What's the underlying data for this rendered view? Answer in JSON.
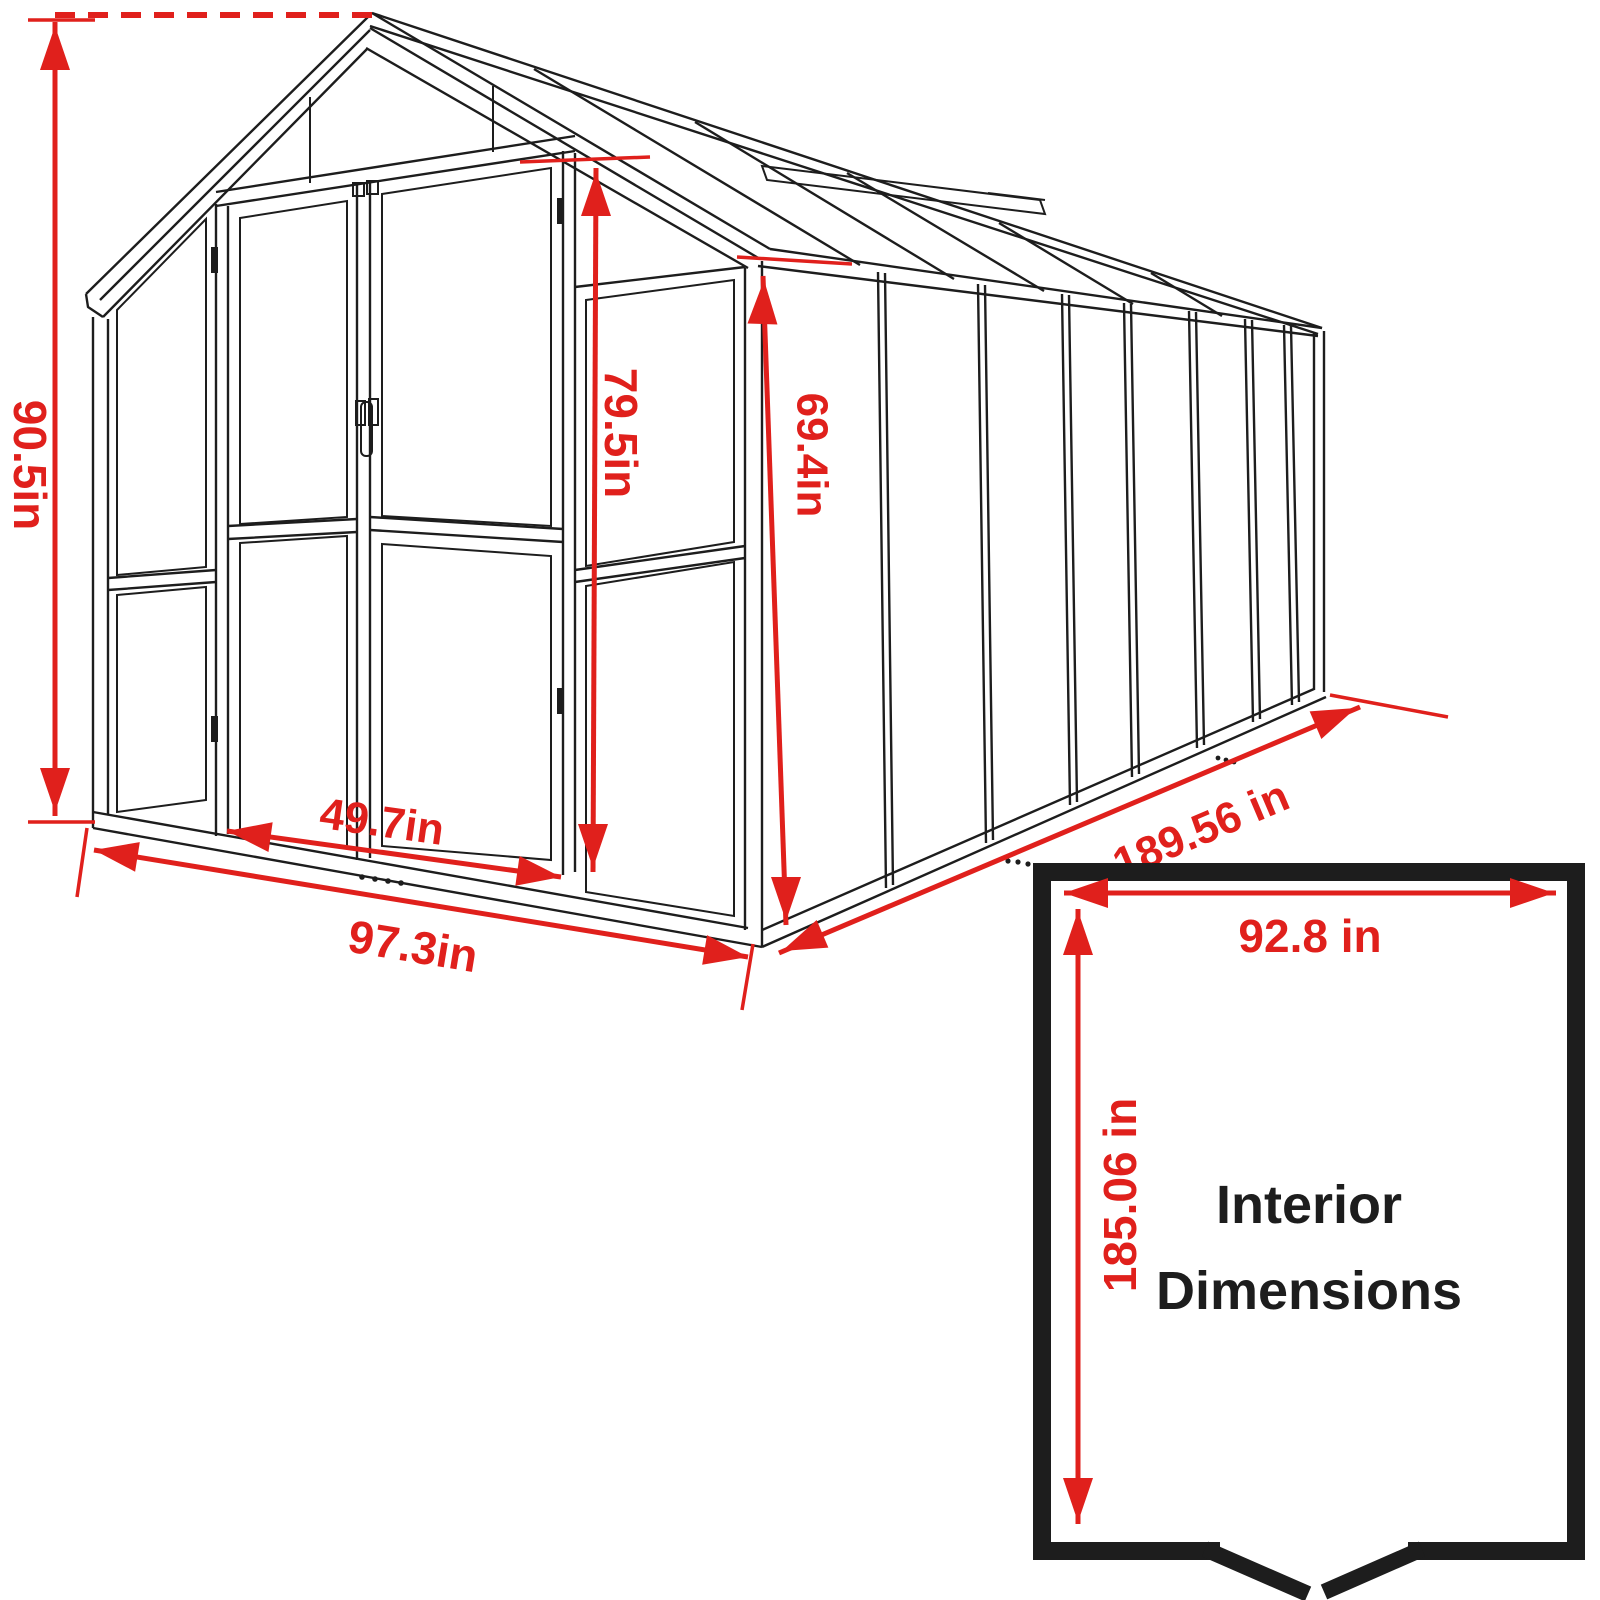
{
  "diagram": {
    "type": "technical-line-drawing",
    "subject": "greenhouse exterior and interior dimensions",
    "dimensions": {
      "overall_height": "90.5in",
      "door_height": "79.5in",
      "side_wall_height": "69.4in",
      "door_width": "49.7in",
      "front_width": "97.3in",
      "length": "189.56 in"
    },
    "inset": {
      "title_line1": "Interior",
      "title_line2": "Dimensions",
      "interior_width": "92.8 in",
      "interior_depth": "185.06 in"
    },
    "colors": {
      "dimension_red": "#e0201c",
      "line_black": "#1d1d1d",
      "background": "#ffffff"
    }
  }
}
